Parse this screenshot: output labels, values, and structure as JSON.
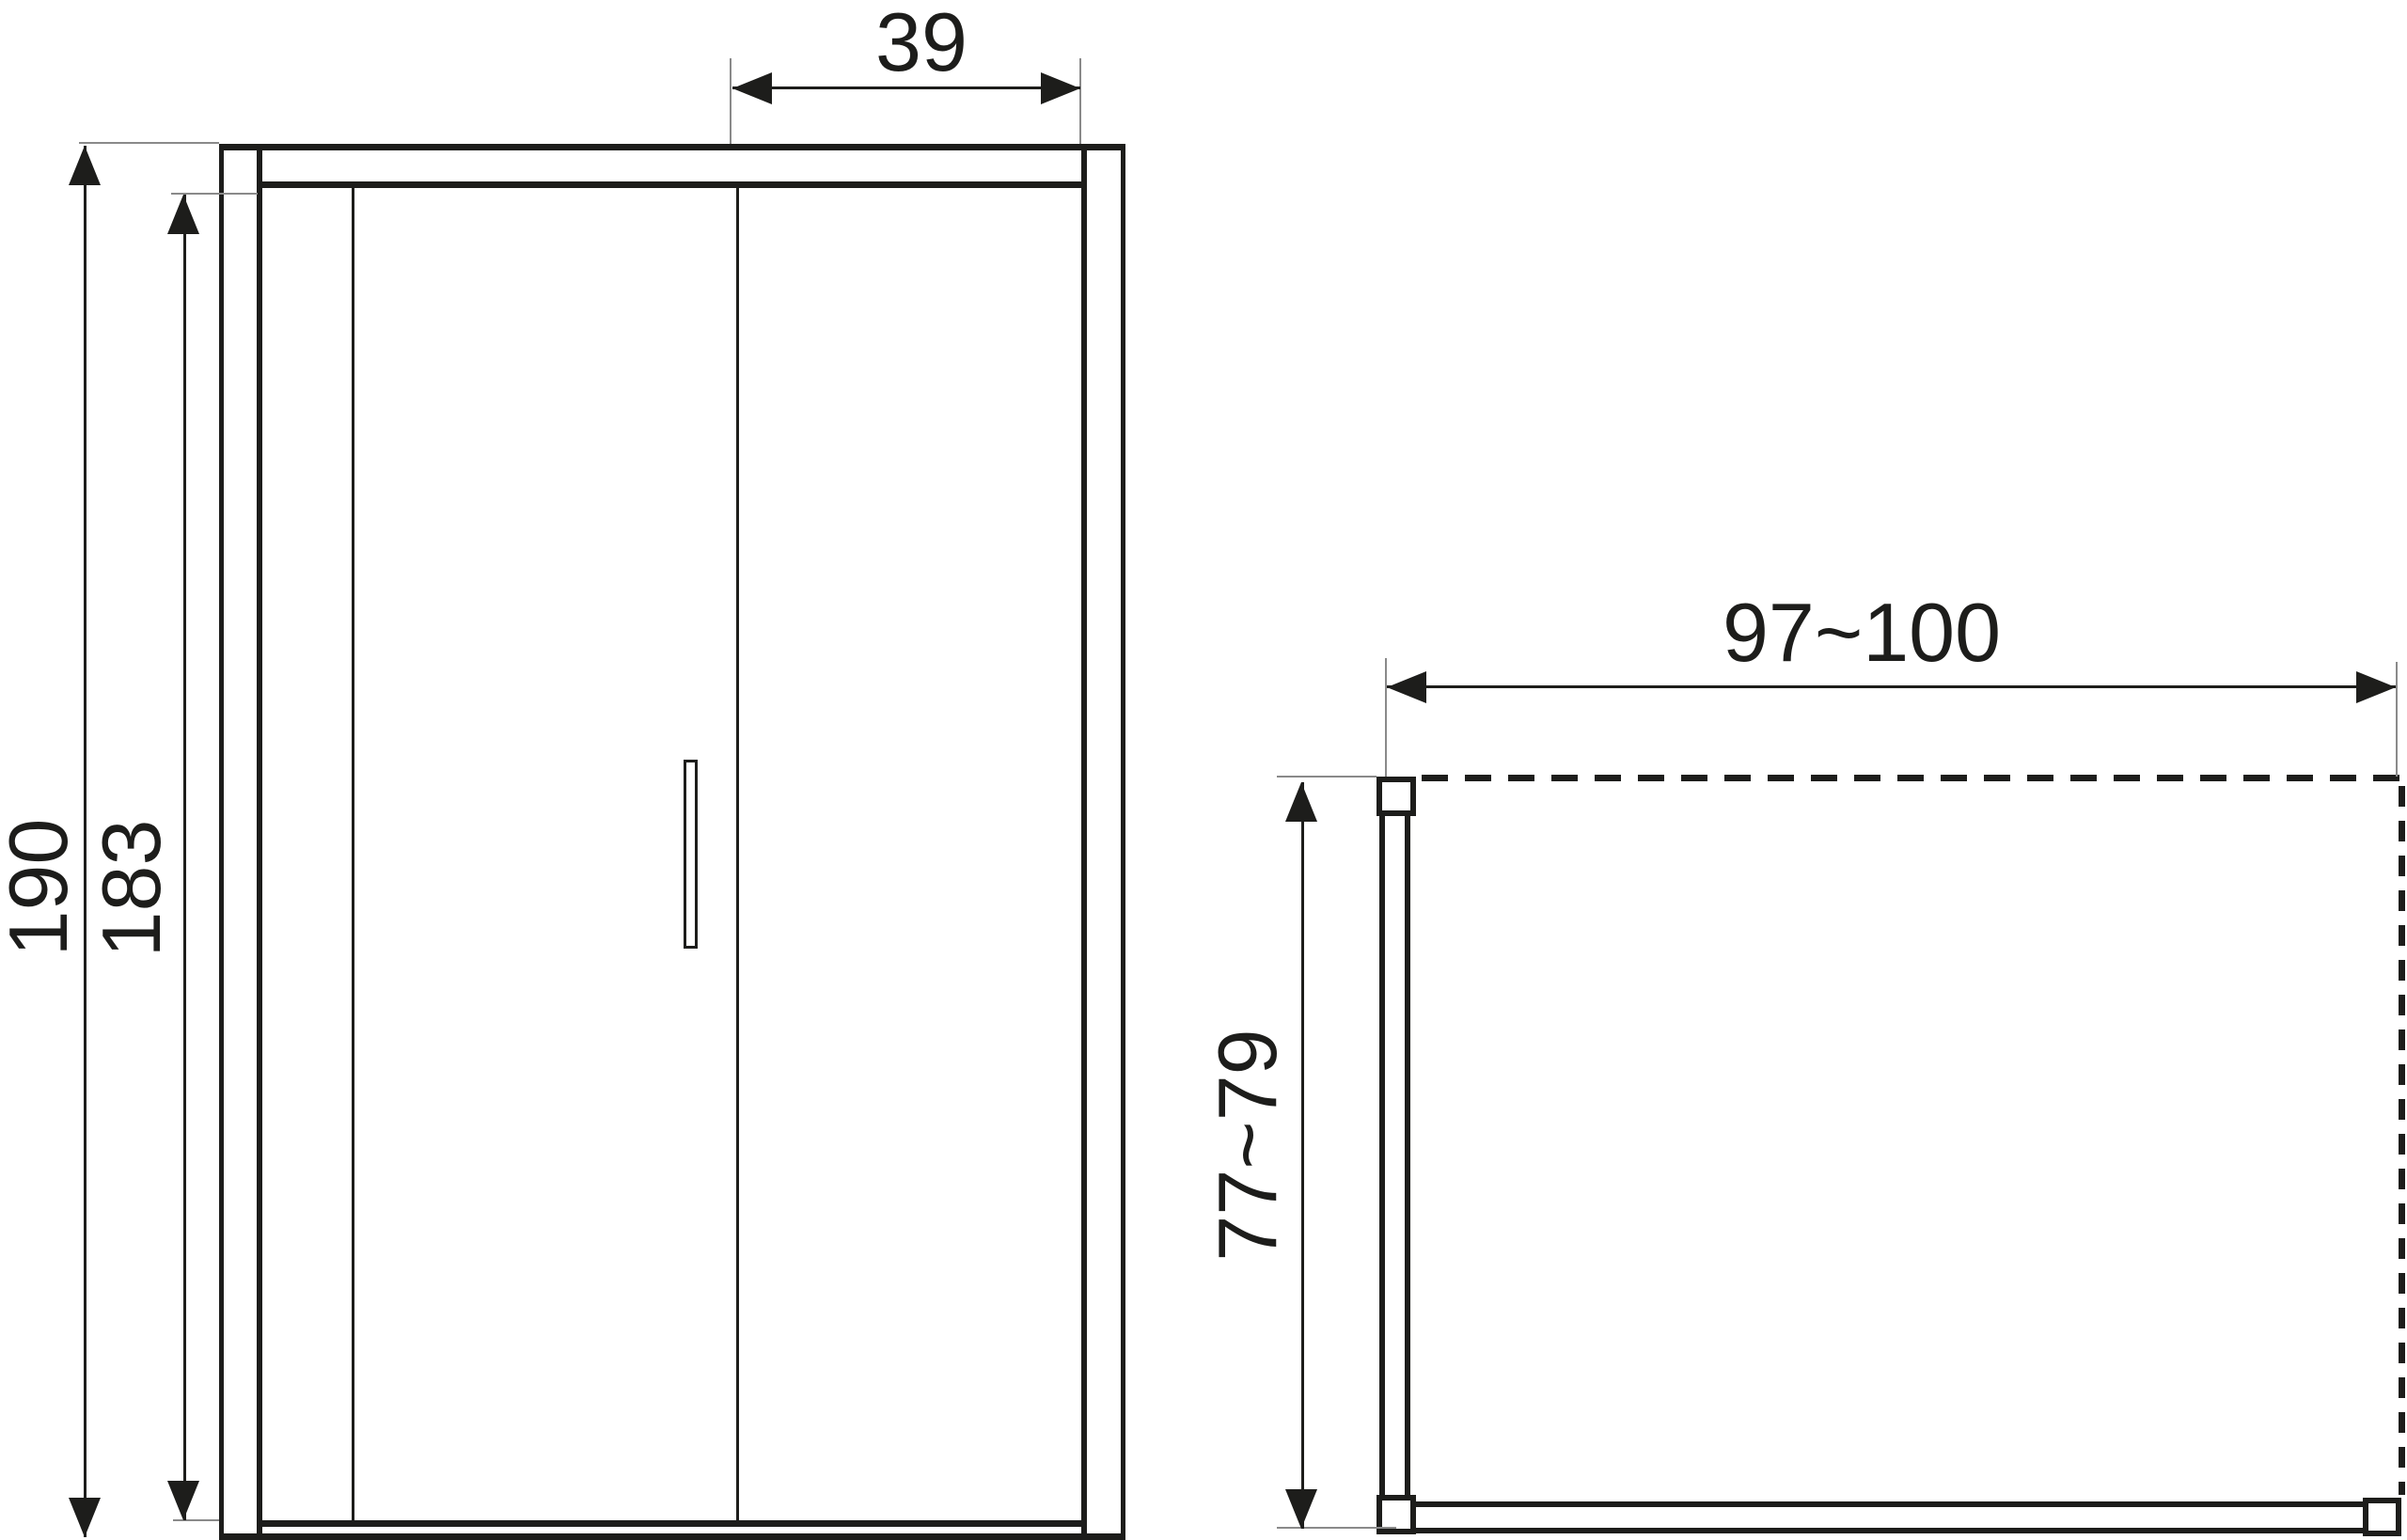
{
  "drawing": {
    "front_view": {
      "label_total_height": "190",
      "label_glass_height": "183",
      "label_door_width": "39"
    },
    "top_view": {
      "label_width_range": "97~100",
      "label_depth_range": "77~79"
    }
  },
  "colors": {
    "line": "#1d1d1b",
    "extension_line": "#8a8a8a",
    "background": "#ffffff"
  }
}
